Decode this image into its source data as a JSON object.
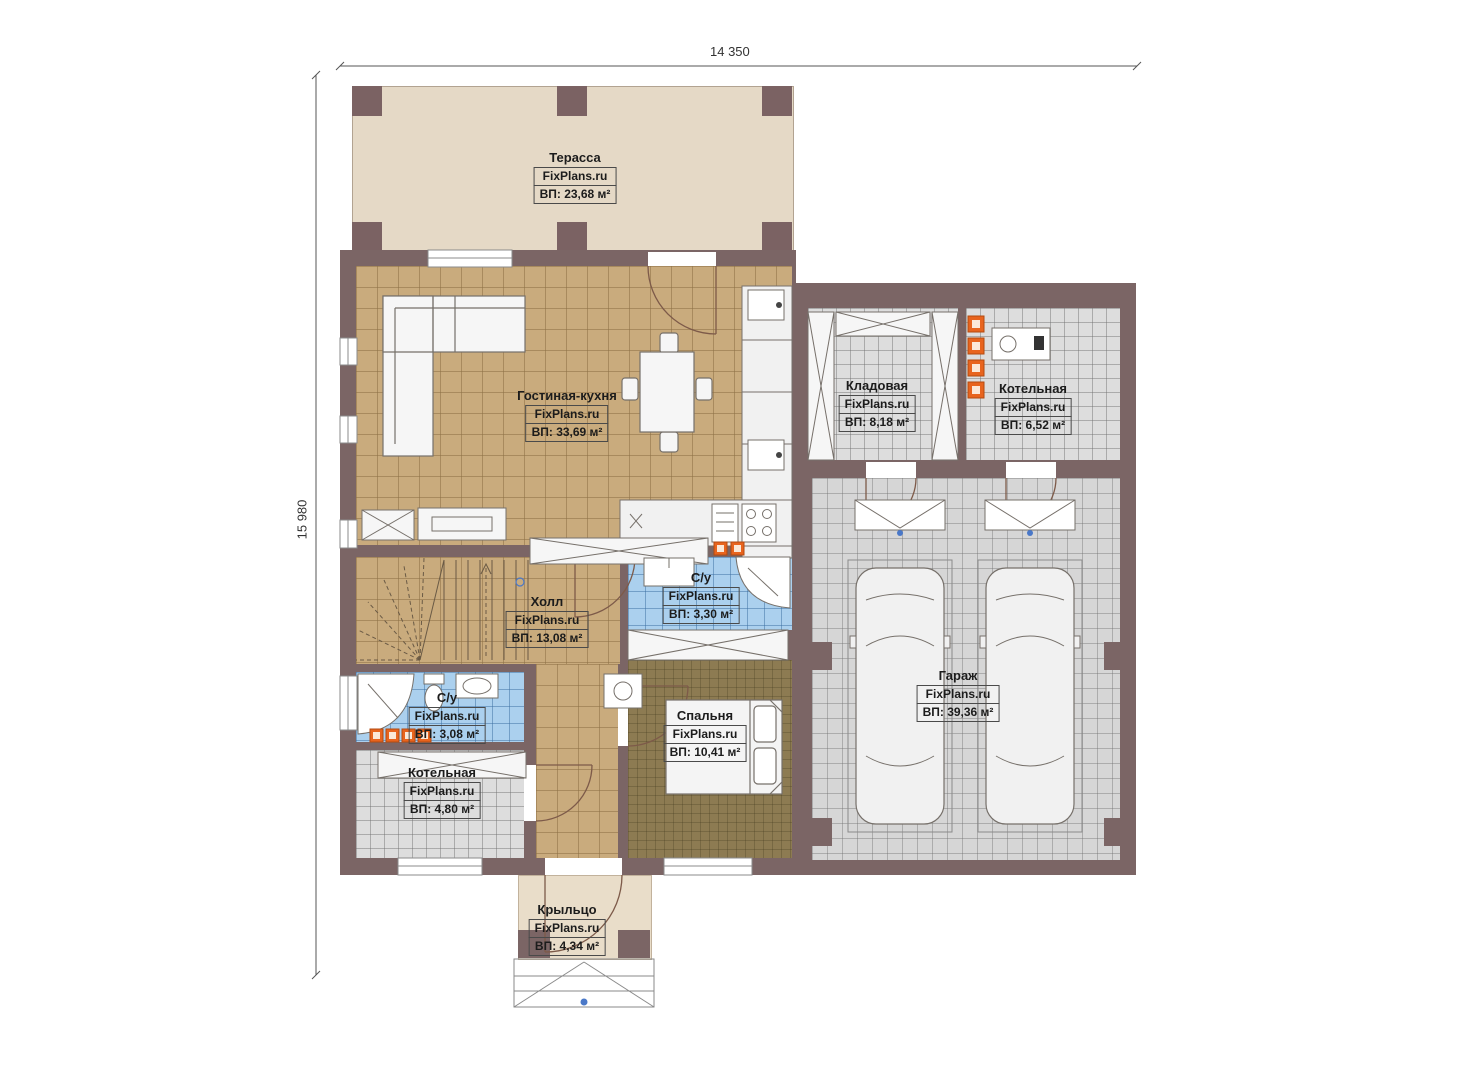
{
  "meta": {
    "brand": "FixPlans.ru"
  },
  "dimensions": {
    "width_label": "14 350",
    "height_label": "15 980"
  },
  "colors": {
    "wall": "#7b6565",
    "floor_living": "#c9ab7d",
    "floor_bedroom": "#8d7b52",
    "floor_bath": "#abd0ee",
    "floor_utility": "#dddddd",
    "terrace": "#e5d9c6",
    "accent_radiator": "#e8641e",
    "marker_blue": "#4a78c8"
  },
  "rooms": [
    {
      "name": "Терасса",
      "area": "ВП: 23,68 м²"
    },
    {
      "name": "Гостиная-кухня",
      "area": "ВП: 33,69 м²"
    },
    {
      "name": "Кладовая",
      "area": "ВП: 8,18 м²"
    },
    {
      "name": "Котельная",
      "area": "ВП: 6,52 м²"
    },
    {
      "name": "Холл",
      "area": "ВП: 13,08 м²"
    },
    {
      "name": "С/у",
      "area": "ВП: 3,30 м²"
    },
    {
      "name": "Спальня",
      "area": "ВП: 10,41 м²"
    },
    {
      "name": "С/у",
      "area": "ВП: 3,08 м²"
    },
    {
      "name": "Котельная",
      "area": "ВП: 4,80 м²"
    },
    {
      "name": "Гараж",
      "area": "ВП: 39,36 м²"
    },
    {
      "name": "Крыльцо",
      "area": "ВП: 4,34 м²"
    }
  ]
}
